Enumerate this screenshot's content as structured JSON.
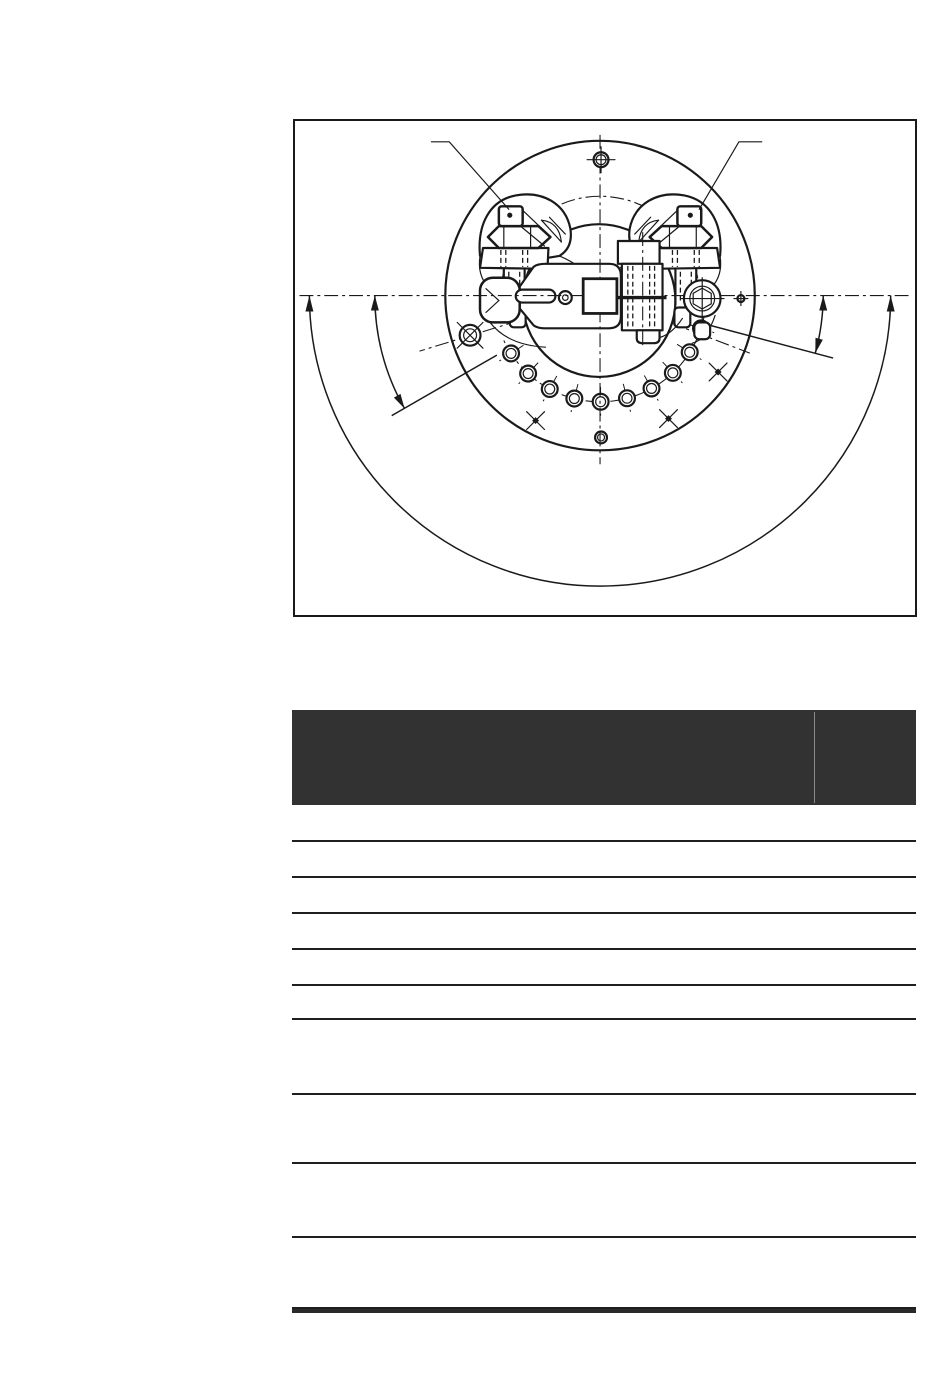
{
  "colors": {
    "paper": "#ffffff",
    "drawing_stroke": "#1a1a1a",
    "table_header_fill": "#323232",
    "table_line": "#1f1f1f",
    "table_thick_rule": "#2a2a2a",
    "header_divider": "#8a8a8a"
  },
  "figure": {
    "kind": "engineering-line-drawing",
    "subject": "circular flange assembly top view with two stud-and-nut clamps, center pointer arm, arc of indicator holes and angular dimension arcs",
    "visible_text": []
  },
  "table": {
    "header": {
      "main_label": "",
      "right_label": "",
      "divider_pct": 83.6
    },
    "rows": [
      {
        "label": "",
        "height": 35
      },
      {
        "label": "",
        "height": 34
      },
      {
        "label": "",
        "height": 34
      },
      {
        "label": "",
        "height": 34
      },
      {
        "label": "",
        "height": 34
      },
      {
        "label": "",
        "height": 32
      },
      {
        "label": "",
        "height": 73
      },
      {
        "label": "",
        "height": 67
      },
      {
        "label": "",
        "height": 72
      },
      {
        "label": "",
        "height": 69
      }
    ]
  }
}
